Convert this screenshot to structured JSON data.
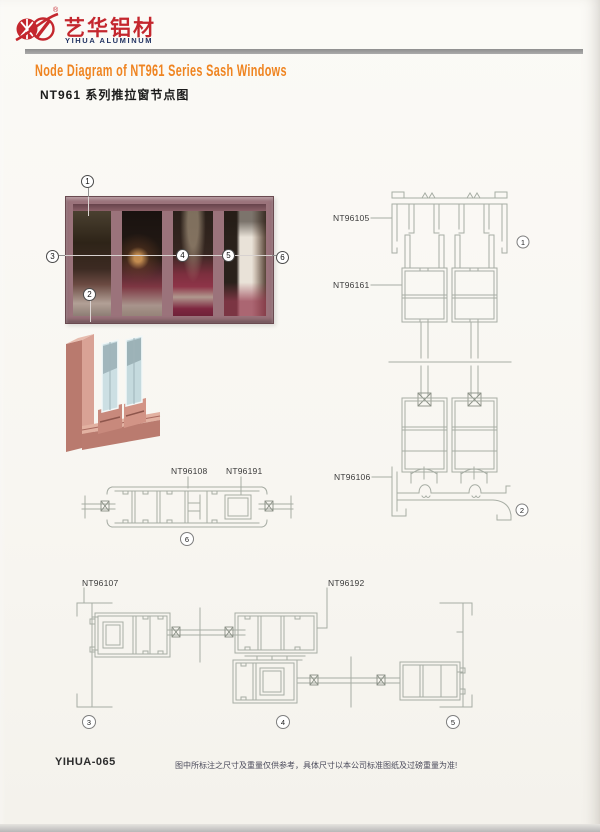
{
  "header": {
    "brand_cn": "艺华铝材",
    "brand_en": "YIHUA ALUMINUM",
    "registered_mark": "®",
    "title_en": "Node Diagram of NT961 Series Sash Windows",
    "title_cn": "NT961 系列推拉窗节点图"
  },
  "part_labels": {
    "head_frame": "NT96105",
    "sash": "NT96161",
    "sill_frame": "NT96106",
    "interlock": "NT96108",
    "glazing_profile": "NT96191",
    "jamb_frame": "NT96107",
    "meeting_profile": "NT96192"
  },
  "callouts": {
    "n1": "1",
    "n2": "2",
    "n3": "3",
    "n4": "4",
    "n5": "5",
    "n6": "6"
  },
  "footer": {
    "page_code": "YIHUA-065",
    "disclaimer": "图中所标注之尺寸及重量仅供参考，具体尺寸以本公司标准图纸及过磅重量为准!"
  },
  "colors": {
    "accent_orange": "#ef8420",
    "brand_red": "#c4272e",
    "brand_navy": "#233463",
    "drawing_line": "#a7ada4",
    "photo_frame": "#9b737b"
  }
}
